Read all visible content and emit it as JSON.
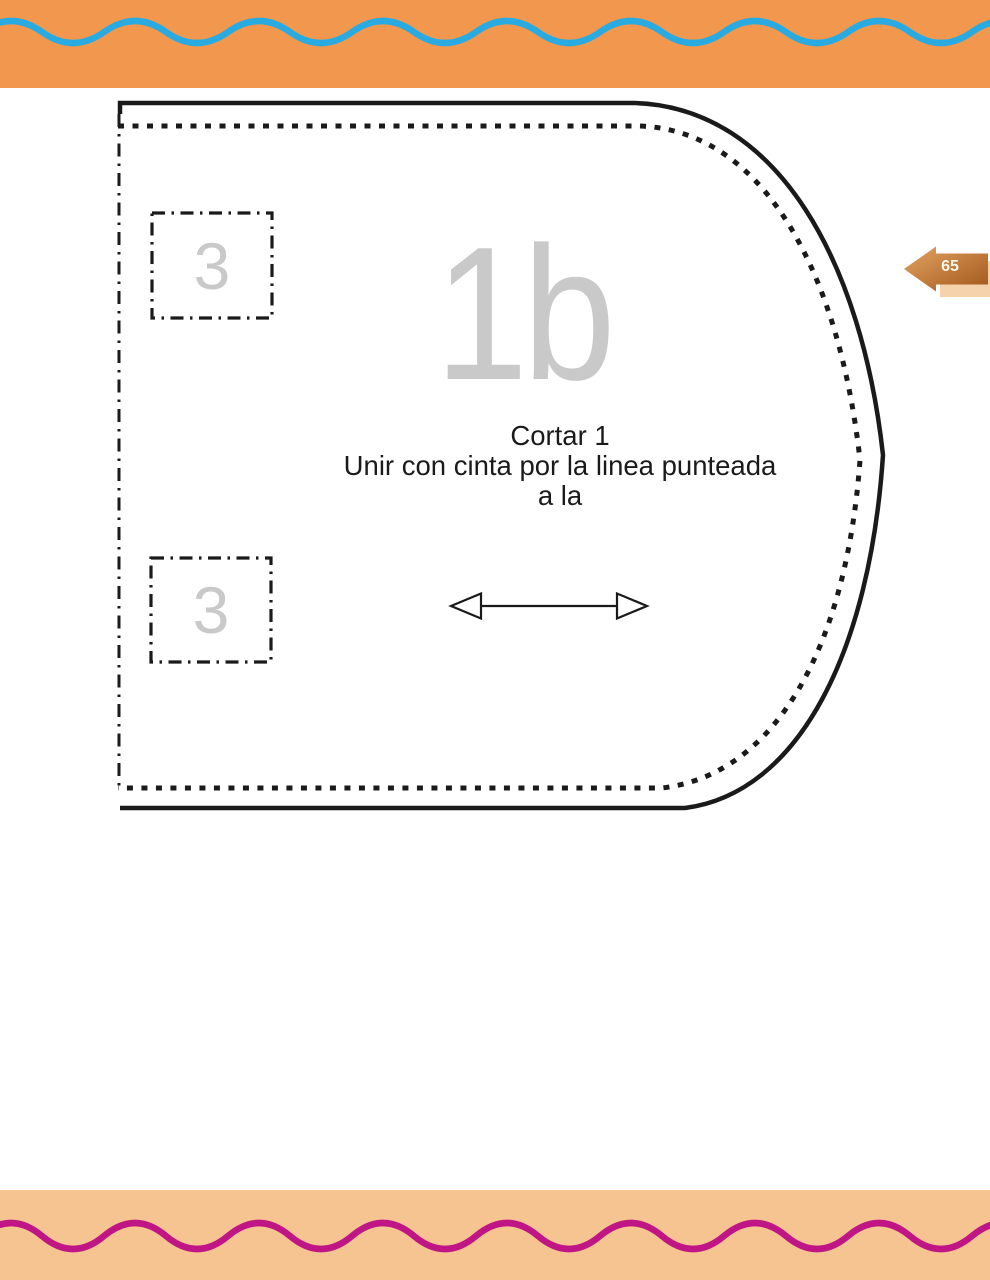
{
  "header": {
    "band_color": "#F2974E",
    "wave_color": "#29ABE2"
  },
  "footer": {
    "band_color": "#F6C491",
    "wave_color": "#C01585"
  },
  "page_marker": {
    "page_number": "65"
  },
  "pattern": {
    "piece_label": "1b",
    "notch_labels": [
      "3",
      "3"
    ],
    "instructions_line1": "Cortar 1",
    "instructions_line2": "Unir con cinta por la linea punteada",
    "instructions_line3": "a la"
  },
  "colors": {
    "outline": "#1a1a1a",
    "muted_label": "#C9C9C9"
  }
}
